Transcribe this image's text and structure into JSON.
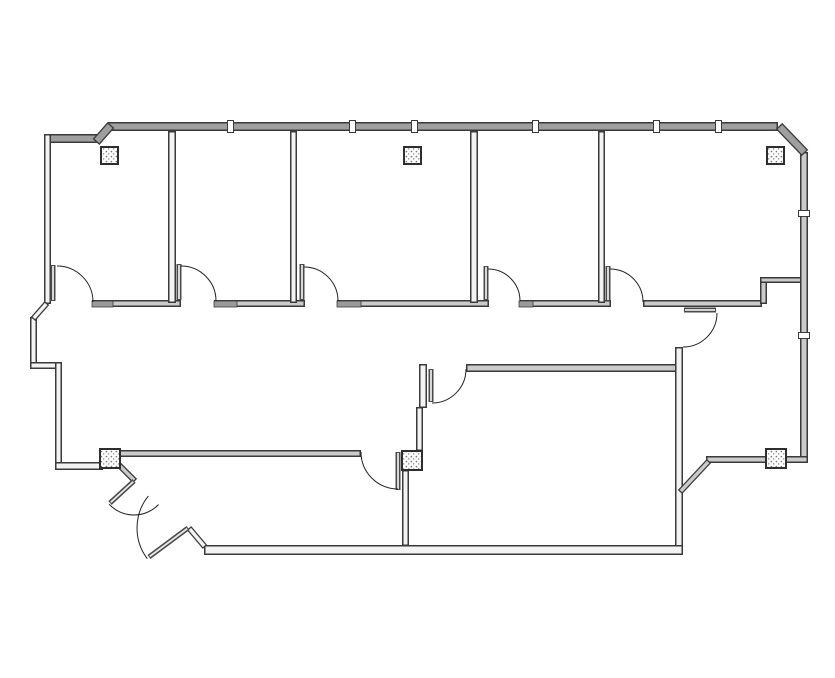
{
  "document": {
    "title": "office-suite-floor-plan",
    "type": "architectural-floor-plan"
  },
  "drawing": {
    "canvas": {
      "width": 835,
      "height": 678,
      "background": "#ffffff"
    },
    "palette": {
      "line": "#3a3a3a",
      "fill_dark": "#9f9f9f",
      "fill_mid": "#cbcbcb",
      "fill_light": "#f3f3f3",
      "arc": "#222222",
      "sill": "#9a9a9a",
      "leaf": "#4a4a4a",
      "column_border": "#2e2e2e",
      "column_fill": "#fdfdfd",
      "speckle": "#777777"
    },
    "walls": [
      {
        "name": "top-exterior-wall",
        "x": 108,
        "y": 122,
        "w": 670,
        "h": 9,
        "fill": "dark"
      },
      {
        "name": "topleft-exterior-wall",
        "x": 44,
        "y": 134,
        "w": 53,
        "h": 9,
        "fill": "dark"
      },
      {
        "name": "left-exterior-wall-upper",
        "x": 44,
        "y": 134,
        "w": 7,
        "h": 170,
        "fill": "light"
      },
      {
        "name": "left-exterior-wall-mid",
        "x": 30,
        "y": 317,
        "w": 7,
        "h": 51,
        "fill": "light"
      },
      {
        "name": "left-jog-wall",
        "x": 30,
        "y": 362,
        "w": 31,
        "h": 7,
        "fill": "light"
      },
      {
        "name": "left-exterior-wall-lower",
        "x": 55,
        "y": 362,
        "w": 7,
        "h": 106,
        "fill": "light"
      },
      {
        "name": "entry-side-wall",
        "x": 55,
        "y": 462,
        "w": 48,
        "h": 8,
        "fill": "light"
      },
      {
        "name": "corridor-wall-seg-1",
        "x": 92,
        "y": 300,
        "w": 89,
        "h": 7,
        "fill": "mid"
      },
      {
        "name": "corridor-wall-seg-2",
        "x": 214,
        "y": 300,
        "w": 91,
        "h": 7,
        "fill": "mid"
      },
      {
        "name": "corridor-wall-seg-3",
        "x": 337,
        "y": 300,
        "w": 152,
        "h": 7,
        "fill": "mid"
      },
      {
        "name": "corridor-wall-seg-4",
        "x": 520,
        "y": 300,
        "w": 91,
        "h": 7,
        "fill": "mid"
      },
      {
        "name": "corridor-wall-seg-5",
        "x": 643,
        "y": 300,
        "w": 119,
        "h": 7,
        "fill": "mid"
      },
      {
        "name": "office-divider-1-2",
        "x": 168,
        "y": 131,
        "w": 8,
        "h": 172,
        "fill": "light"
      },
      {
        "name": "office-divider-2-3",
        "x": 290,
        "y": 131,
        "w": 7,
        "h": 172,
        "fill": "light"
      },
      {
        "name": "office-divider-3-4",
        "x": 470,
        "y": 131,
        "w": 8,
        "h": 172,
        "fill": "light"
      },
      {
        "name": "office-divider-4-5",
        "x": 598,
        "y": 131,
        "w": 7,
        "h": 172,
        "fill": "light"
      },
      {
        "name": "notch-wall-vertical",
        "x": 760,
        "y": 277,
        "w": 7,
        "h": 27,
        "fill": "mid"
      },
      {
        "name": "notch-wall-horizontal",
        "x": 760,
        "y": 277,
        "w": 46,
        "h": 6,
        "fill": "mid"
      },
      {
        "name": "right-exterior-wall",
        "x": 800,
        "y": 152,
        "w": 8,
        "h": 310,
        "fill": "mid"
      },
      {
        "name": "wing-bottom-wall",
        "x": 706,
        "y": 456,
        "w": 102,
        "h": 7,
        "fill": "mid"
      },
      {
        "name": "lower-left-room-top-wall",
        "x": 118,
        "y": 450,
        "w": 243,
        "h": 7,
        "fill": "mid"
      },
      {
        "name": "lower-right-room-top-wall",
        "x": 466,
        "y": 364,
        "w": 217,
        "h": 8,
        "fill": "mid"
      },
      {
        "name": "lower-right-room-right-wall",
        "x": 675,
        "y": 347,
        "w": 8,
        "h": 208,
        "fill": "light"
      },
      {
        "name": "bottom-exterior-wall",
        "x": 204,
        "y": 545,
        "w": 479,
        "h": 10,
        "fill": "light"
      },
      {
        "name": "center-stub-wall-upper",
        "x": 419,
        "y": 364,
        "w": 8,
        "h": 44,
        "fill": "light"
      },
      {
        "name": "center-stub-wall-lower",
        "x": 416,
        "y": 407,
        "w": 7,
        "h": 44,
        "fill": "light"
      },
      {
        "name": "center-divider-wall",
        "x": 402,
        "y": 470,
        "w": 7,
        "h": 76,
        "fill": "light"
      }
    ],
    "diagonal_walls": [
      {
        "name": "topleft-chamfer-wall",
        "x1": 96,
        "y1": 142,
        "x2": 111,
        "y2": 125,
        "t": 9,
        "fill": "dark"
      },
      {
        "name": "topright-chamfer-wall",
        "x1": 779,
        "y1": 126,
        "x2": 805,
        "y2": 153,
        "t": 9,
        "fill": "dark"
      },
      {
        "name": "left-jog-diagonal",
        "x1": 47,
        "y1": 303,
        "x2": 33,
        "y2": 319,
        "t": 6,
        "fill": "light"
      },
      {
        "name": "wing-diagonal-wall",
        "x1": 680,
        "y1": 492,
        "x2": 709,
        "y2": 461,
        "t": 6,
        "fill": "mid"
      },
      {
        "name": "entry-jamb-stub-left",
        "x1": 119,
        "y1": 465,
        "x2": 135,
        "y2": 481,
        "t": 6,
        "fill": "mid"
      },
      {
        "name": "entry-jamb-stub-right",
        "x1": 189,
        "y1": 528,
        "x2": 205,
        "y2": 547,
        "t": 6,
        "fill": "light"
      }
    ],
    "door_leaves": [
      {
        "name": "office-1-door-leaf",
        "x1": 53,
        "y1": 265,
        "x2": 53,
        "y2": 301,
        "t": 5
      },
      {
        "name": "office-2-door-leaf",
        "x1": 179,
        "y1": 264,
        "x2": 179,
        "y2": 300,
        "t": 5
      },
      {
        "name": "office-3-door-leaf",
        "x1": 302,
        "y1": 264,
        "x2": 302,
        "y2": 300,
        "t": 5
      },
      {
        "name": "office-4-door-leaf",
        "x1": 486,
        "y1": 266,
        "x2": 486,
        "y2": 300,
        "t": 5
      },
      {
        "name": "office-5-door-leaf",
        "x1": 608,
        "y1": 266,
        "x2": 608,
        "y2": 301,
        "t": 5
      },
      {
        "name": "lower-left-room-door-leaf",
        "x1": 398,
        "y1": 452,
        "x2": 398,
        "y2": 490,
        "t": 5
      },
      {
        "name": "lower-right-room-door-leaf",
        "x1": 431,
        "y1": 369,
        "x2": 431,
        "y2": 402,
        "t": 5
      },
      {
        "name": "wing-door-leaf",
        "x1": 684,
        "y1": 310,
        "x2": 716,
        "y2": 310,
        "t": 5
      },
      {
        "name": "entry-door-leaf-left",
        "x1": 134,
        "y1": 481,
        "x2": 110,
        "y2": 503,
        "t": 5
      },
      {
        "name": "entry-door-leaf-right",
        "x1": 188,
        "y1": 528,
        "x2": 149,
        "y2": 557,
        "t": 5
      }
    ],
    "door_arcs": [
      {
        "name": "office-1-door-arc",
        "cx": 57,
        "cy": 302,
        "r": 36,
        "a1": -90,
        "a2": 0,
        "sweep": 1
      },
      {
        "name": "office-2-door-arc",
        "cx": 181,
        "cy": 301,
        "r": 35,
        "a1": -90,
        "a2": 0,
        "sweep": 1
      },
      {
        "name": "office-3-door-arc",
        "cx": 304,
        "cy": 301,
        "r": 34,
        "a1": -90,
        "a2": 0,
        "sweep": 1
      },
      {
        "name": "office-4-door-arc",
        "cx": 488,
        "cy": 301,
        "r": 32,
        "a1": -90,
        "a2": 0,
        "sweep": 1
      },
      {
        "name": "office-5-door-arc",
        "cx": 610,
        "cy": 302,
        "r": 33,
        "a1": -90,
        "a2": 0,
        "sweep": 1
      },
      {
        "name": "lower-left-room-door-arc",
        "cx": 398,
        "cy": 452,
        "r": 37,
        "a1": 180,
        "a2": 90,
        "sweep": 0
      },
      {
        "name": "lower-right-room-door-arc",
        "cx": 432,
        "cy": 369,
        "r": 34,
        "a1": 90,
        "a2": 0,
        "sweep": 0
      },
      {
        "name": "wing-door-arc",
        "cx": 683,
        "cy": 313,
        "r": 34,
        "a1": 0,
        "a2": 90,
        "sweep": 1
      },
      {
        "name": "entry-door-arc-left",
        "cx": 134,
        "cy": 481,
        "r": 34,
        "a1": 137,
        "a2": 44,
        "sweep": 0
      },
      {
        "name": "entry-door-arc-right",
        "cx": 188,
        "cy": 528,
        "r": 51,
        "a1": 219,
        "a2": 143,
        "sweep": 0
      }
    ],
    "sills": [
      {
        "name": "office-1-door-sill",
        "x": 92,
        "y": 301,
        "w": 21,
        "h": 6
      },
      {
        "name": "office-2-door-sill",
        "x": 214,
        "y": 301,
        "w": 23,
        "h": 6
      },
      {
        "name": "office-3-door-sill",
        "x": 337,
        "y": 301,
        "w": 24,
        "h": 6
      },
      {
        "name": "office-4-door-sill",
        "x": 519,
        "y": 301,
        "w": 14,
        "h": 6
      }
    ],
    "columns": [
      {
        "name": "column-office-1",
        "x": 101,
        "y": 147,
        "w": 17,
        "h": 17
      },
      {
        "name": "column-office-3",
        "x": 404,
        "y": 147,
        "w": 17,
        "h": 17
      },
      {
        "name": "column-office-5",
        "x": 767,
        "y": 147,
        "w": 17,
        "h": 17
      },
      {
        "name": "column-entry",
        "x": 100,
        "y": 449,
        "w": 20,
        "h": 19
      },
      {
        "name": "column-center",
        "x": 402,
        "y": 451,
        "w": 20,
        "h": 19
      },
      {
        "name": "column-wing",
        "x": 766,
        "y": 449,
        "w": 20,
        "h": 19
      }
    ],
    "mullions": [
      {
        "name": "window-mullion-top-1",
        "x": 230,
        "y": 120,
        "orient": "v"
      },
      {
        "name": "window-mullion-top-2",
        "x": 352,
        "y": 120,
        "orient": "v"
      },
      {
        "name": "window-mullion-top-3",
        "x": 414,
        "y": 120,
        "orient": "v"
      },
      {
        "name": "window-mullion-top-4",
        "x": 535,
        "y": 120,
        "orient": "v"
      },
      {
        "name": "window-mullion-top-5",
        "x": 656,
        "y": 120,
        "orient": "v"
      },
      {
        "name": "window-mullion-top-6",
        "x": 718,
        "y": 120,
        "orient": "v"
      },
      {
        "name": "window-mullion-right-1",
        "x": 798,
        "y": 213,
        "orient": "h"
      },
      {
        "name": "window-mullion-right-2",
        "x": 798,
        "y": 335,
        "orient": "h"
      }
    ]
  }
}
